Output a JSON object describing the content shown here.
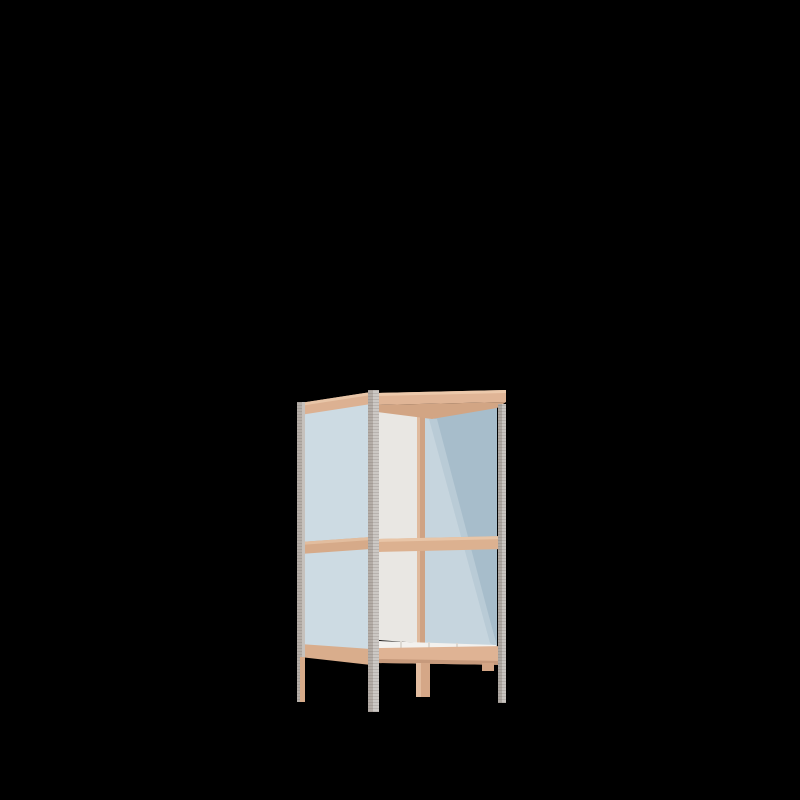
{
  "scene": {
    "description": "3D product render of a two-tier open shelving unit with light wood rails, metal corner posts and pale blue side panels on a black background",
    "object": "shelving-unit",
    "view": "three-quarter front-left",
    "background_color": "#000000"
  },
  "palette": {
    "background": "#000000",
    "wood": "#ddb190",
    "wood_highlight": "#ecc9ab",
    "wood_shadow": "#c79a7c",
    "wood_underside": "#d2a584",
    "metal_dark_face": "#aca69f",
    "metal_light_face": "#c9c5c1",
    "panel_blue_light": "#cddbe3",
    "panel_blue_shadow": "#a7bdcb",
    "panel_white": "#e9e7e3",
    "shelf_white": "#f3f1ee"
  },
  "parts": [
    {
      "name": "back-panel",
      "fill": "#e9e7e3",
      "points": "378,409 421,412 421,643 378,640"
    },
    {
      "name": "left-side-panel",
      "fill": "#cddbe3",
      "points": "302,414 371,403 371,652 302,646"
    },
    {
      "name": "right-side-panel",
      "fill": "#c6d5de",
      "points": "425,418 497,404 497,650 425,645"
    },
    {
      "name": "right-side-panel-shadow",
      "fill": "#a7bdcb",
      "points": "433,419 497,405 497,646"
    },
    {
      "name": "right-side-panel-shadow-edge",
      "fill": "#b9cbd6",
      "points": "429,419 437,419 497,647 490,643"
    },
    {
      "name": "back-right-post",
      "fill": "#cfa384",
      "points": "417,412 425,412 425,665 417,665"
    },
    {
      "name": "back-right-post-highlight",
      "fill": "#e0ba9d",
      "points": "417,412 420,412 420,665 417,665"
    },
    {
      "name": "top-shelf-underside",
      "fill": "#d2a584",
      "points": "377,405 506,402 497,408 432,419 377,412"
    },
    {
      "name": "bottom-shelf-surface",
      "fill": "#f3f1ee",
      "points": "379,641 496,645 496,649 379,648"
    },
    {
      "name": "bottom-shelf-slat",
      "fill": "#dcd8d2",
      "points": "400,641 402,641 402,648 400,648"
    },
    {
      "name": "bottom-shelf-slat",
      "fill": "#dcd8d2",
      "points": "428,642 430,642 430,648 428,648"
    },
    {
      "name": "bottom-shelf-slat",
      "fill": "#dcd8d2",
      "points": "456,643 458,643 458,649 456,649"
    },
    {
      "name": "front-middle-rail",
      "fill": "#dcb190",
      "points": "378,539 506,536 506,549 378,552"
    },
    {
      "name": "front-middle-rail-highlight",
      "fill": "#e8c5a7",
      "points": "378,539 506,536 506,539 378,542"
    },
    {
      "name": "left-middle-rail",
      "fill": "#d6aa89",
      "points": "300,542 371,537 371,549 300,554"
    },
    {
      "name": "left-middle-rail-highlight",
      "fill": "#e2bd9e",
      "points": "300,542 371,537 371,540 300,545"
    },
    {
      "name": "left-bottom-rail",
      "fill": "#d9ad8c",
      "points": "300,644 371,649 371,665 300,657"
    },
    {
      "name": "front-bottom-rail",
      "fill": "#dfb394",
      "points": "378,648 506,646 506,665 378,663"
    },
    {
      "name": "front-bottom-rail-shadow",
      "fill": "#c79a7c",
      "points": "378,659 506,661 506,665 378,663"
    },
    {
      "name": "rear-right-foot",
      "fill": "#d3a585",
      "points": "482,663 494,663 494,671 482,671"
    },
    {
      "name": "back-right-leg",
      "fill": "#d5a787",
      "points": "416,663 430,663 430,697 416,697"
    },
    {
      "name": "back-right-leg-highlight",
      "fill": "#e3bda0",
      "points": "416,663 421,663 421,697 416,697"
    },
    {
      "name": "left-top-rail",
      "fill": "#dcb192",
      "points": "300,403 371,392 371,404 300,415"
    },
    {
      "name": "left-top-rail-highlight",
      "fill": "#e8c5a7",
      "points": "300,403 371,392 371,395 300,406"
    },
    {
      "name": "front-top-rail",
      "fill": "#e0b596",
      "points": "377,393 506,390 506,402 377,405"
    },
    {
      "name": "front-top-rail-highlight",
      "fill": "#ecc9ab",
      "points": "377,393 506,390 506,393 377,396"
    },
    {
      "name": "back-left-post",
      "fill": "#b5aea8",
      "points": "297,402 305,402 305,702 297,702",
      "texture": "metal"
    },
    {
      "name": "back-left-post-light-face",
      "fill": "#c6c1bc",
      "points": "302,402 305,402 305,657 302,657"
    },
    {
      "name": "back-left-leg",
      "fill": "#d7ab8a",
      "points": "300,657 305,657 305,702 300,702"
    },
    {
      "name": "front-left-post",
      "fill": "#b3aca6",
      "points": "368,390 379,390 379,712 368,712",
      "texture": "metal"
    },
    {
      "name": "front-left-post-light-face",
      "fill": "#ccc8c4",
      "points": "373,390 379,390 379,712 373,712",
      "texture": "metal"
    },
    {
      "name": "front-right-post",
      "fill": "#aea8a2",
      "points": "498,404 506,404 506,703 498,703",
      "texture": "metal"
    },
    {
      "name": "front-right-post-light-face",
      "fill": "#c8c4c0",
      "points": "502,404 506,404 506,703 502,703",
      "texture": "metal"
    }
  ]
}
